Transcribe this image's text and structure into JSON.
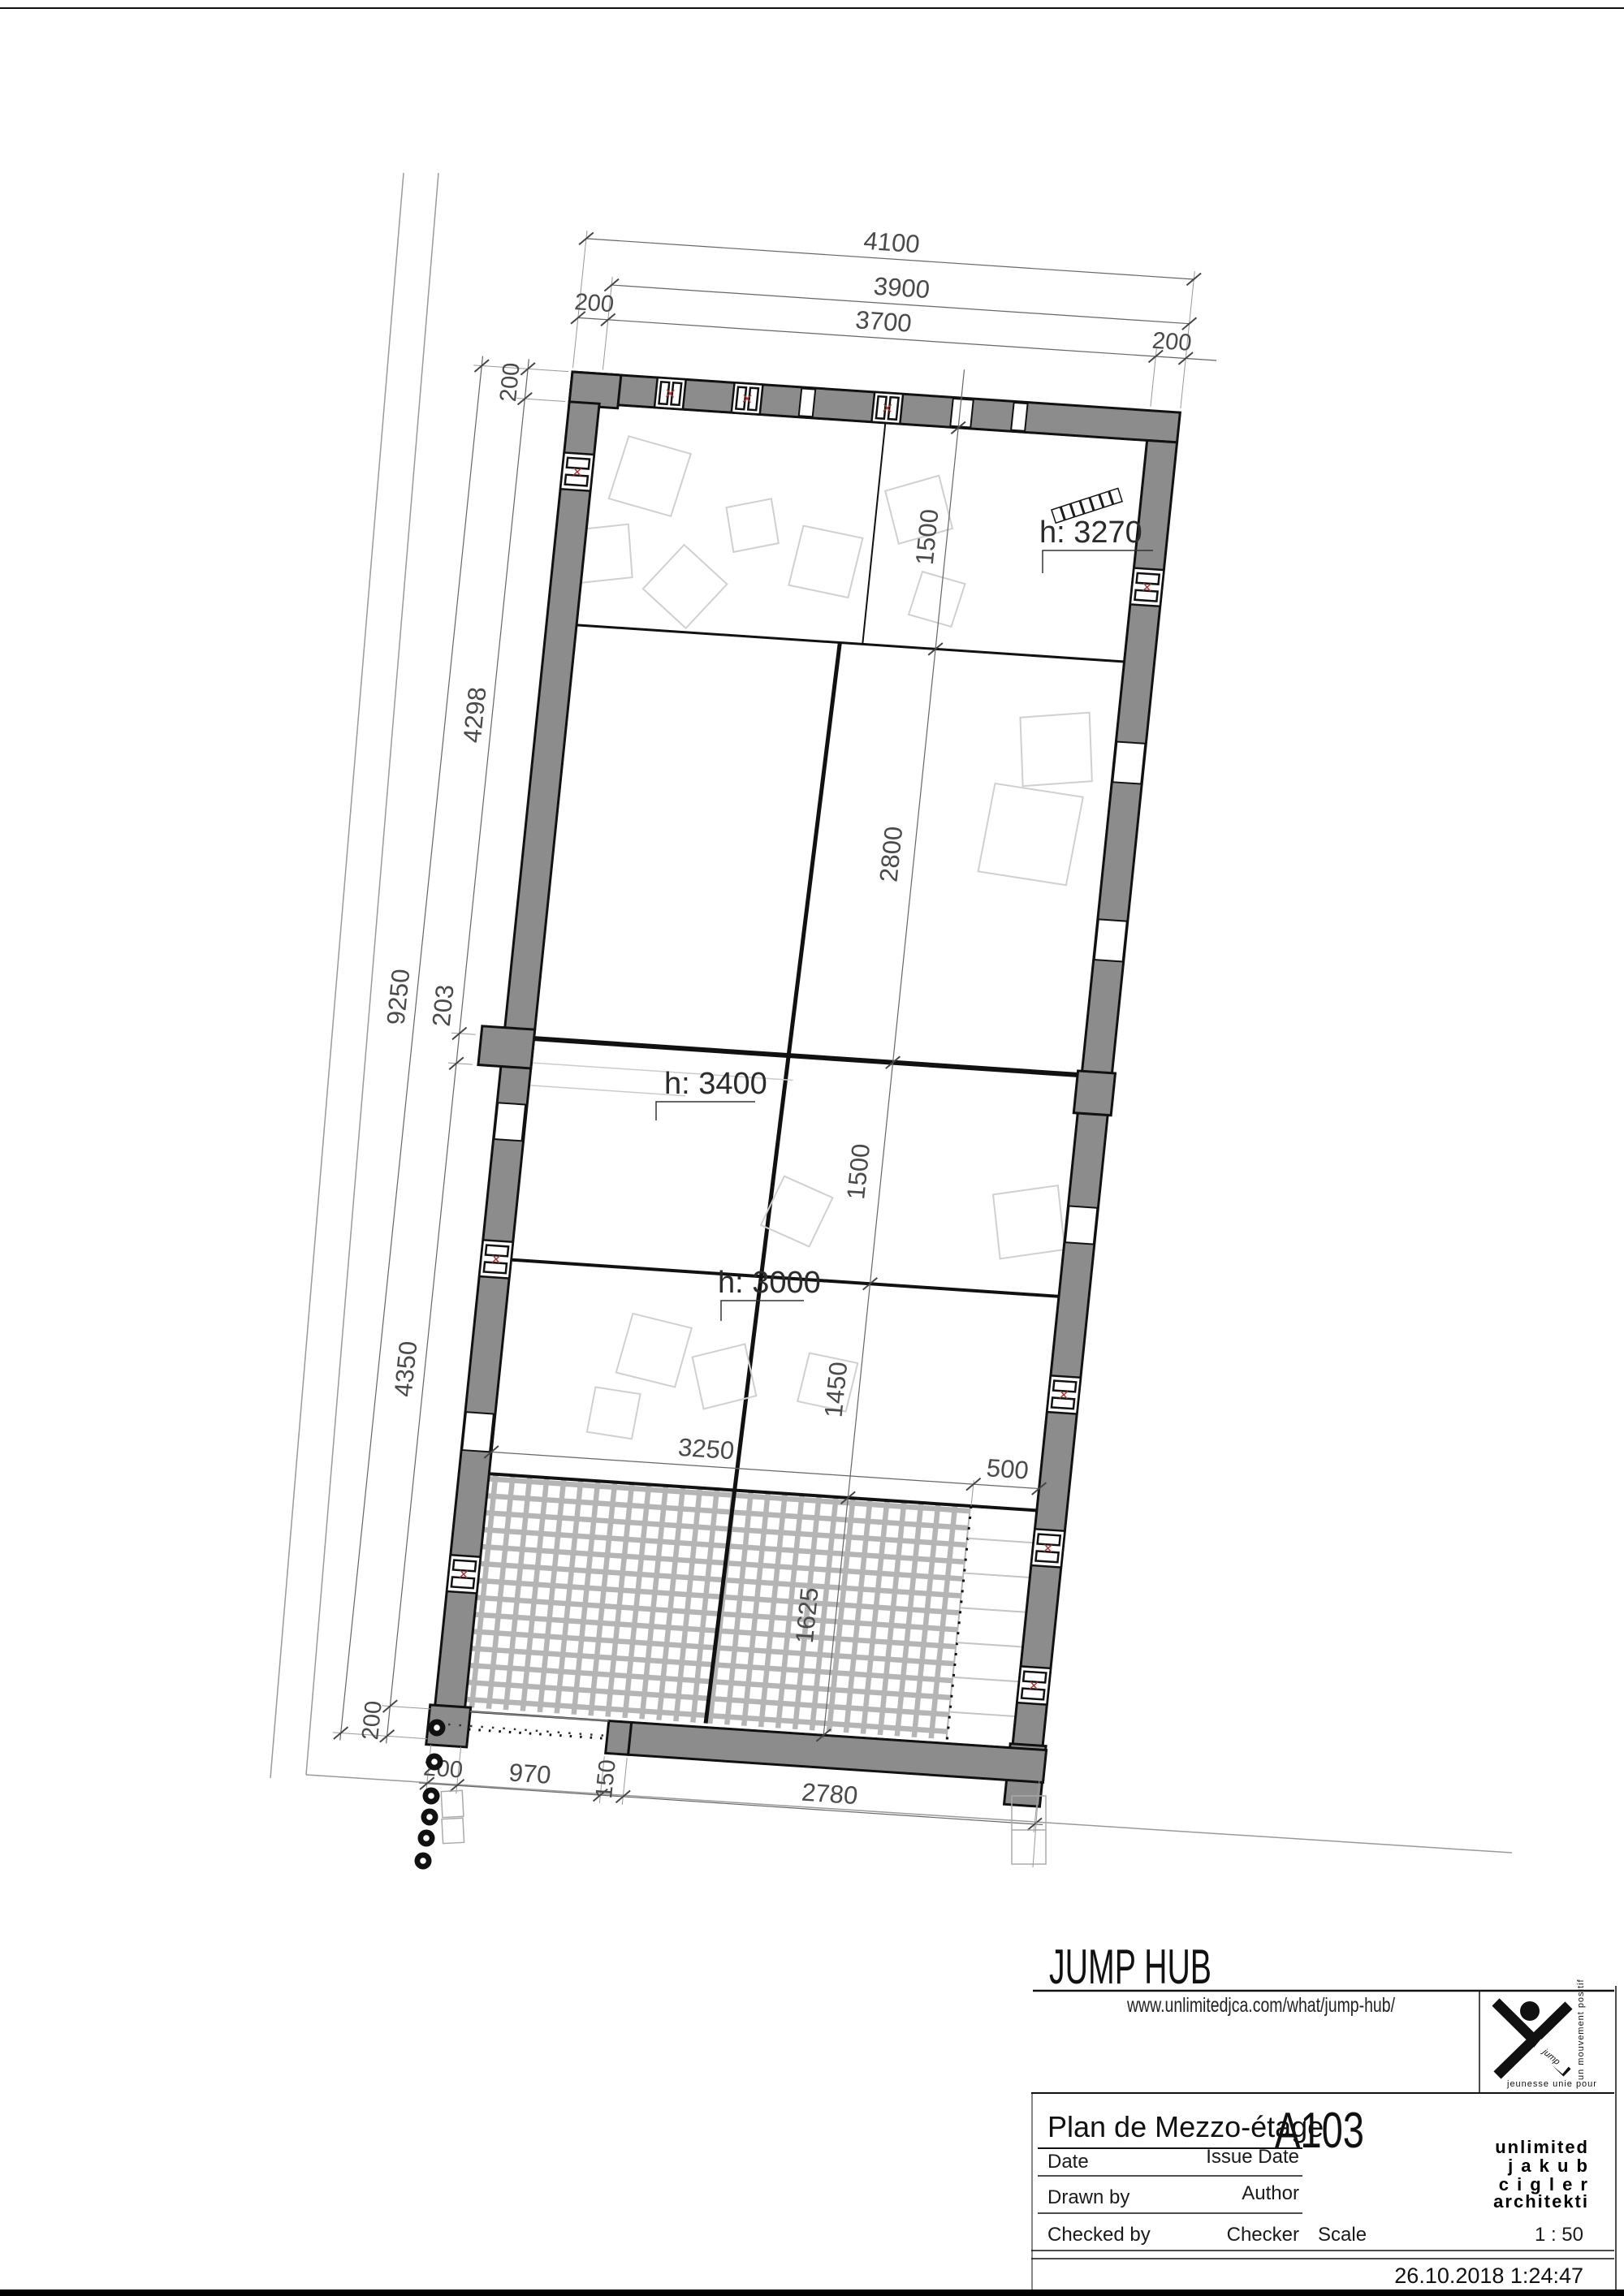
{
  "sheet": {
    "project": "JUMP HUB",
    "url": "www.unlimitedjca.com/what/jump-hub/",
    "view_title": "Plan de Mezzo-étage",
    "sheet_number": "A103",
    "firm_line1": "unlimited",
    "firm_line2": "j a k u b",
    "firm_line3": "c i g l e r",
    "firm_line4": "architekti",
    "fields": {
      "date_label": "Date",
      "date_value": "Issue Date",
      "drawn_label": "Drawn by",
      "drawn_value": "Author",
      "checked_label": "Checked by",
      "checked_value": "Checker",
      "scale_label": "Scale",
      "scale_value": "1 : 50"
    },
    "timestamp": "26.10.2018 1:24:47",
    "logo": {
      "ribbon": "jump",
      "caption": "jeunesse unie pour",
      "side": "un mouvement positif"
    }
  },
  "plan": {
    "heights": {
      "h_a": "h: 3270",
      "h_b": "h: 3400",
      "h_c": "h: 3000"
    },
    "dims": {
      "top_overall": "4100",
      "top_mid": "3900",
      "top_inner": "3700",
      "wall": "200",
      "left_upper": "4298",
      "left_overall": "9250",
      "left_step": "203",
      "left_lower": "4350",
      "right_band1": "1500",
      "right_band2": "2800",
      "right_band3": "1500",
      "right_band4": "1450",
      "hatch_width": "3250",
      "hatch_rest": "500",
      "hatch_depth": "1625",
      "bottom_opening": "970",
      "bottom_pier": "150",
      "bottom_wall": "2780"
    }
  },
  "colors": {
    "wall_gray": "#8c8c8c",
    "net_gray": "#b5b5b5",
    "ink": "#111111",
    "dim_gray": "#4a4a4a",
    "accent_red": "#b03535"
  }
}
